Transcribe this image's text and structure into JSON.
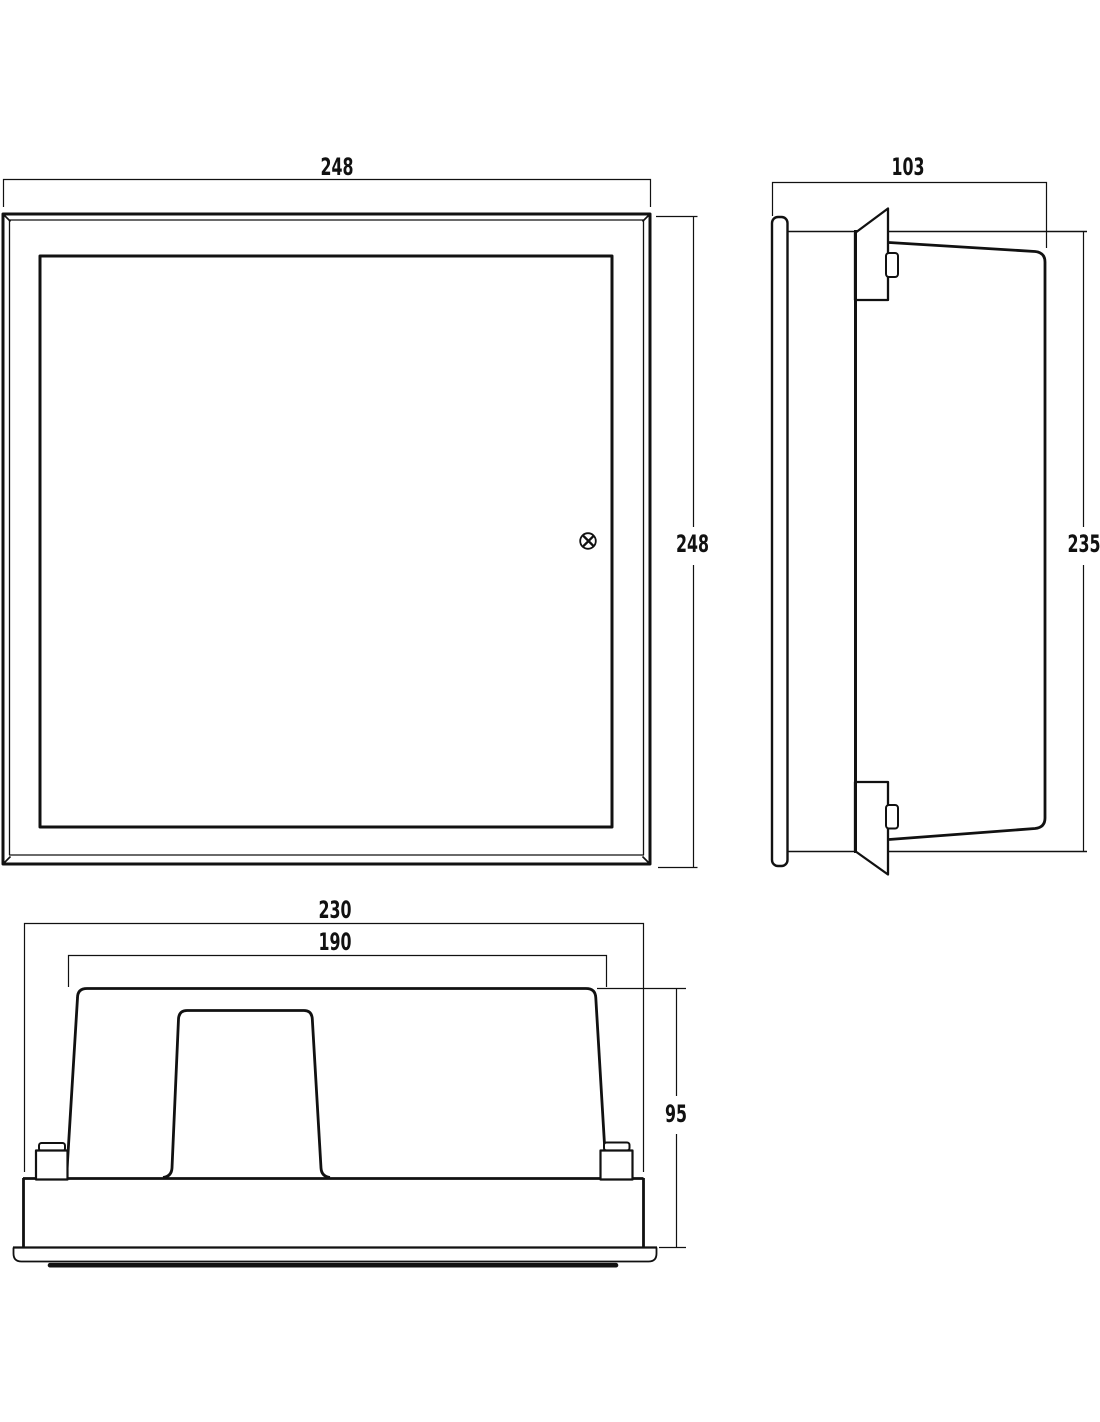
{
  "drawing": {
    "kind": "technical-drawing-three-views",
    "colors": {
      "line": "#111111",
      "background": "#ffffff"
    },
    "views": {
      "front": {
        "width": "248",
        "height": "248"
      },
      "side": {
        "width": "103",
        "height": "235"
      },
      "bottom": {
        "outer_width": "230",
        "inner_width": "190",
        "height": "95"
      }
    }
  }
}
